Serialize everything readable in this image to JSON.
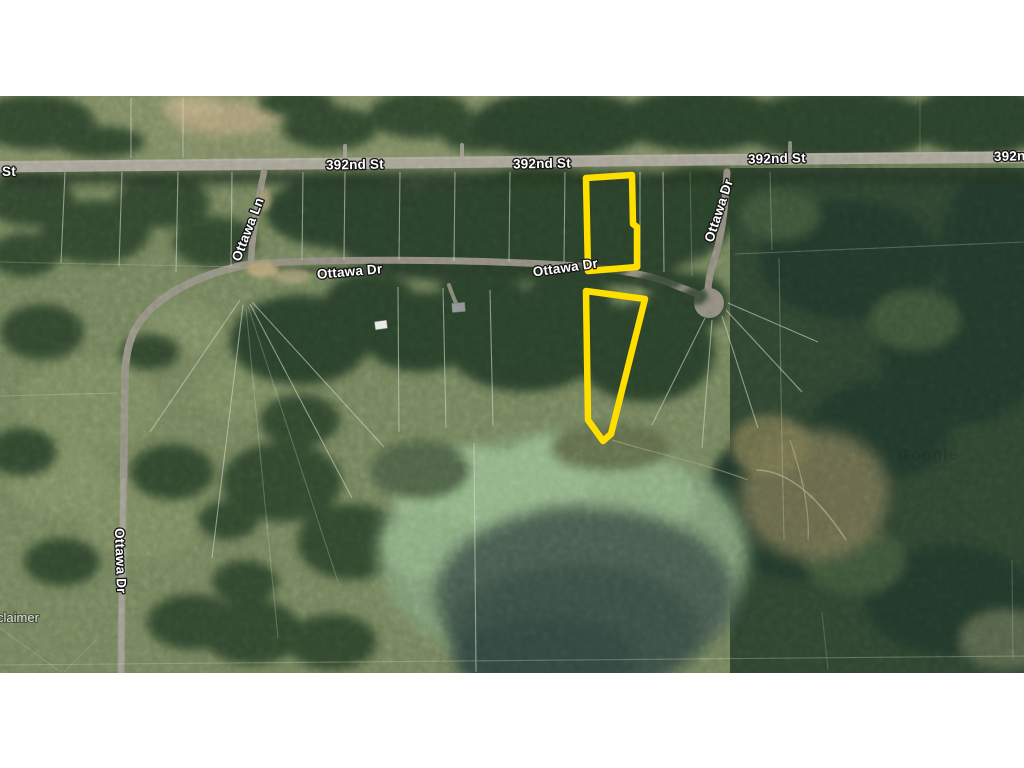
{
  "window": {
    "background": "#ffffff"
  },
  "map": {
    "type": "satellite-imagery",
    "highlight_color": "#ffdf00",
    "road_labels": [
      {
        "text": "St"
      },
      {
        "text": "392nd St"
      },
      {
        "text": "392nd St"
      },
      {
        "text": "392nd St"
      },
      {
        "text": "392nd St"
      },
      {
        "text": "Ottawa Ln"
      },
      {
        "text": "Ottawa Dr"
      },
      {
        "text": "Ottawa Dr"
      },
      {
        "text": "Ottawa Dr"
      },
      {
        "text": "Ottawa Dr"
      }
    ],
    "attribution_fragment": "claimer",
    "watermark": "Google"
  }
}
